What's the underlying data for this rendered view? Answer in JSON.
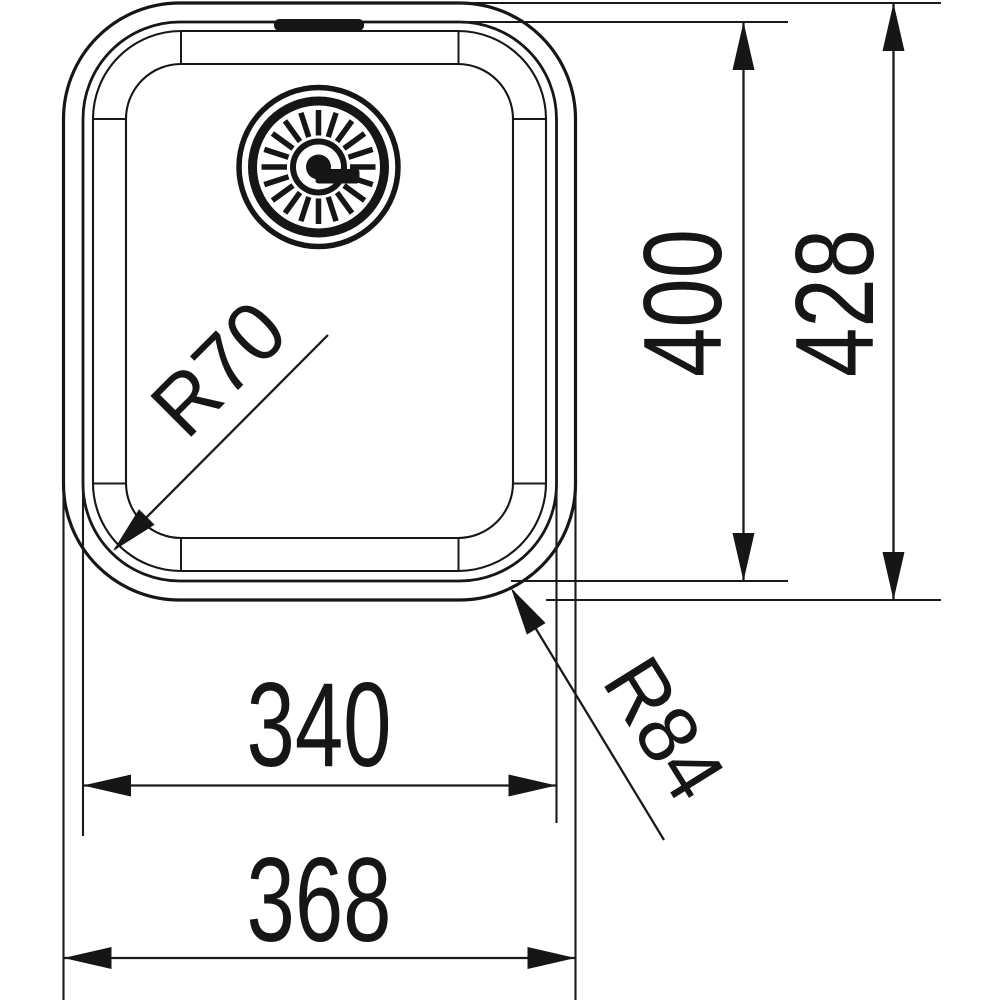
{
  "page": {
    "background_color": "#ffffff",
    "line_color": "#161616",
    "content": "technical dimension drawing of a rectangular undermount sink bowl, top view, with drain strainer"
  },
  "dimensions": {
    "inner_width": {
      "label": "340",
      "value": 340,
      "orientation": "horizontal"
    },
    "outer_width": {
      "label": "368",
      "value": 368,
      "orientation": "horizontal"
    },
    "inner_height": {
      "label": "400",
      "value": 400,
      "orientation": "vertical"
    },
    "outer_height": {
      "label": "428",
      "value": 428,
      "orientation": "vertical"
    },
    "inner_corner_radius": {
      "label": "R70",
      "value": 70
    },
    "outer_corner_radius": {
      "label": "R84",
      "value": 84
    }
  },
  "drain": {
    "spoke_count": 20
  }
}
